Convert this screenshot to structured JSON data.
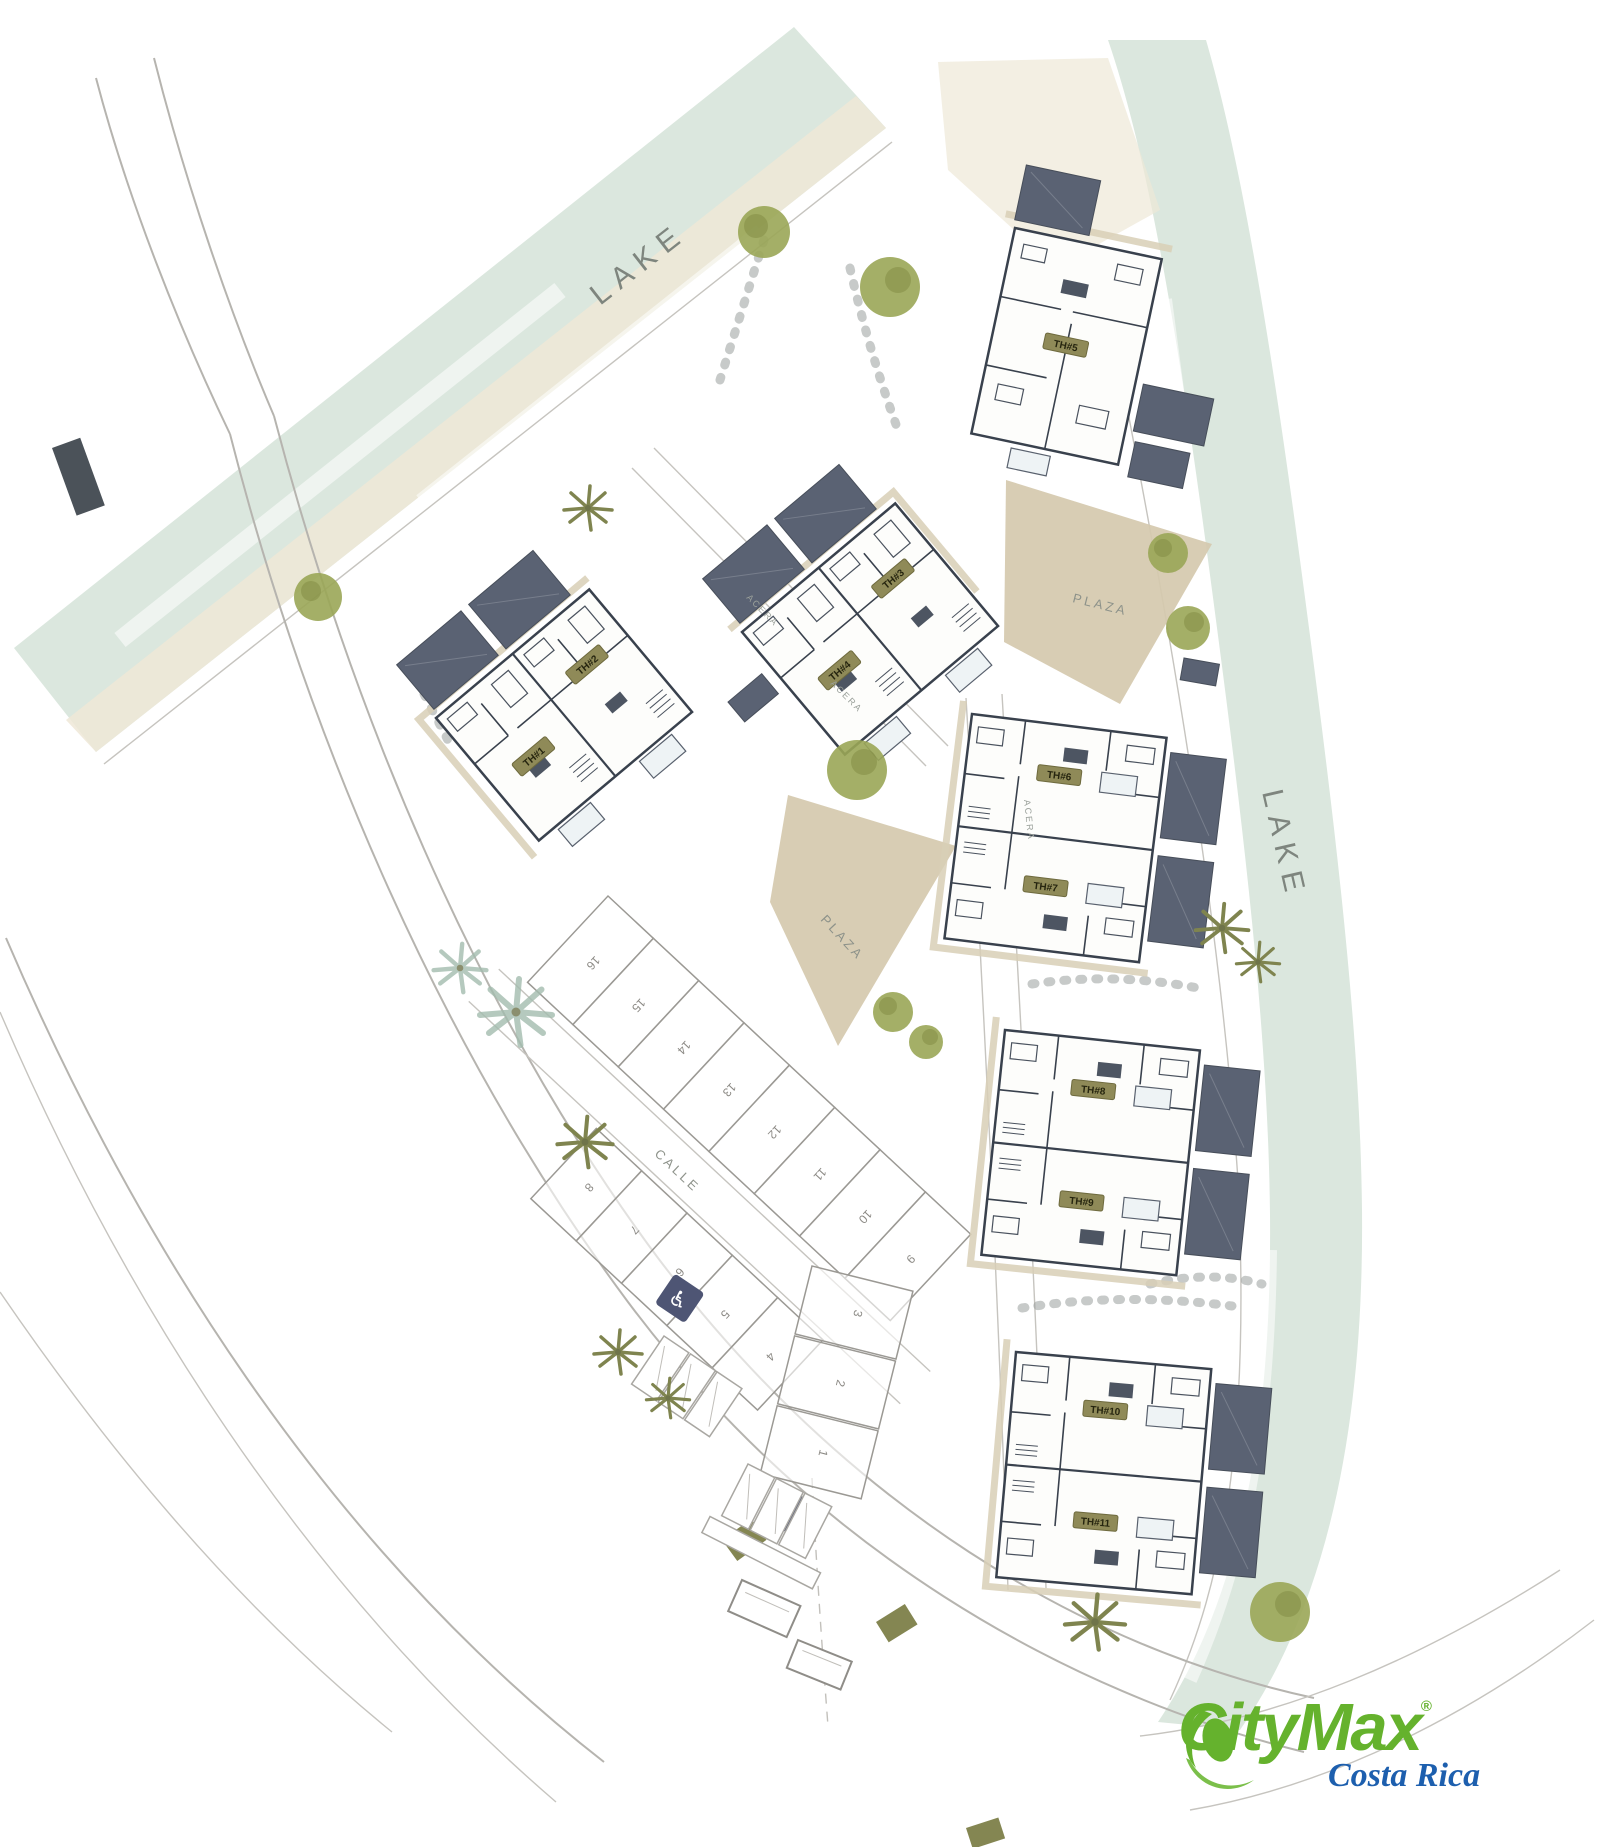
{
  "canvas": {
    "width": 1600,
    "height": 1847
  },
  "labels": {
    "lake_top": "LAKE",
    "lake_right": "LAKE",
    "plaza_upper": "PLAZA",
    "plaza_central": "PLAZA",
    "street": "CALLE",
    "walkway_1": "ACERA",
    "walkway_2": "ACERA"
  },
  "units": [
    {
      "label": "TH#1"
    },
    {
      "label": "TH#2"
    },
    {
      "label": "TH#3"
    },
    {
      "label": "TH#4"
    },
    {
      "label": "TH#5"
    },
    {
      "label": "TH#6"
    },
    {
      "label": "TH#7"
    },
    {
      "label": "TH#8"
    },
    {
      "label": "TH#9"
    },
    {
      "label": "TH#10"
    },
    {
      "label": "TH#11"
    }
  ],
  "lots": {
    "row_a": [
      "16",
      "15",
      "14",
      "13",
      "12",
      "11",
      "10",
      "9"
    ],
    "row_b": [
      "8",
      "7",
      "6",
      "5",
      "4"
    ],
    "column": [
      "3",
      "2",
      "1"
    ]
  },
  "icons": {
    "handicap": "♿"
  },
  "logo": {
    "brand": "CityMax",
    "registered": "®",
    "region": "Costa Rica",
    "brand_color": "#65b22d",
    "region_color": "#1d5fae"
  },
  "colors": {
    "lake": "#dbe7de",
    "sand": "#eee8d7",
    "plaza": "#d5c9ae",
    "roof": "#5a6273",
    "wall_line": "#39414d",
    "road_line": "#b6b4af",
    "tree": "#9aa657",
    "palm": "#7f844f",
    "badge": "#8f8a58",
    "crosswalk": "#4b5259",
    "speed_bump": "#77793f",
    "handicap_bg": "#4e5574"
  }
}
